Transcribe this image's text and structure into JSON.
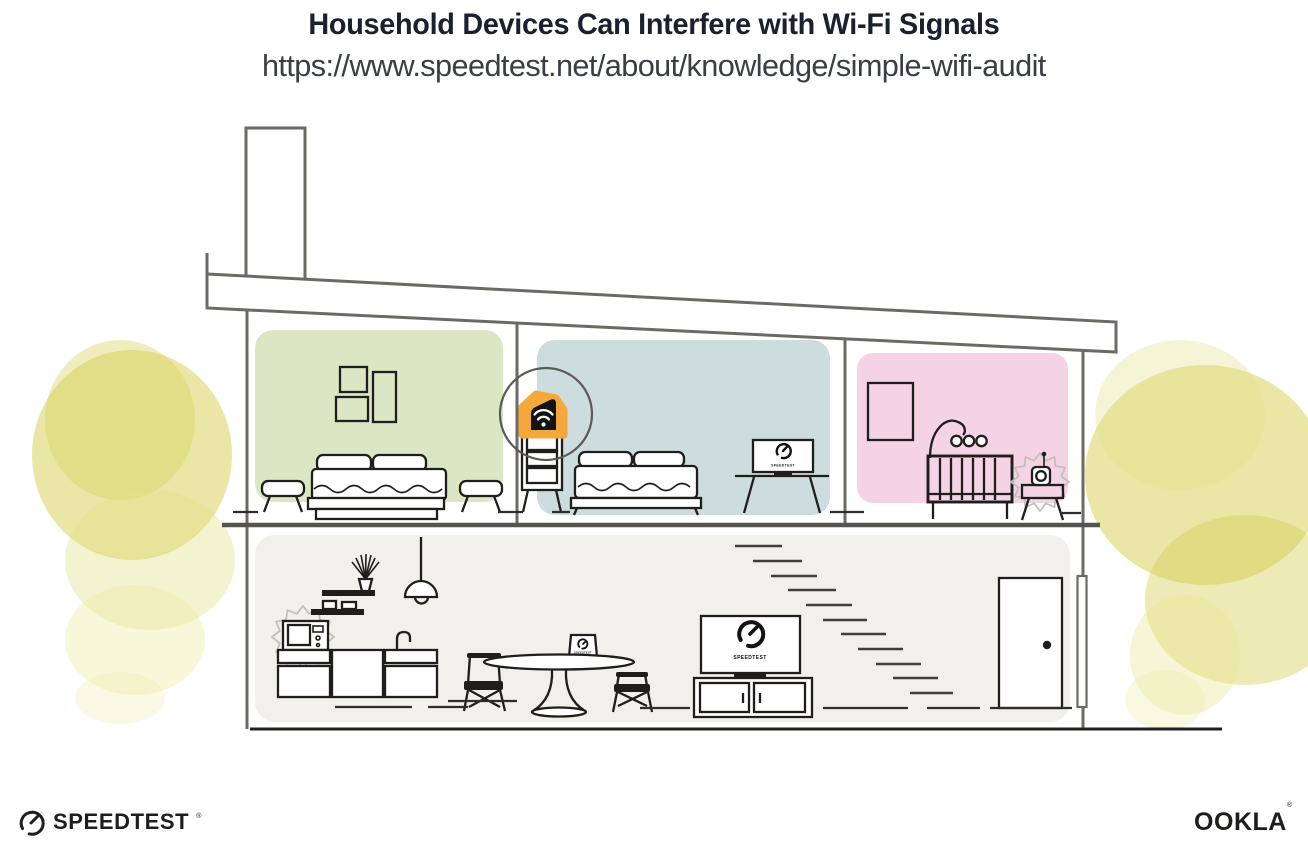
{
  "header": {
    "title": "Household Devices Can Interfere with Wi-Fi Signals",
    "url": "https://www.speedtest.net/about/knowledge/simple-wifi-audit"
  },
  "screens": {
    "tv_label": "SPEEDTEST",
    "bedroom_monitor_label": "SPEEDTEST",
    "dining_laptop_label": "SPEEDTEST"
  },
  "footer": {
    "speedtest_wordmark": "SPEEDTEST",
    "speedtest_trademark": "®",
    "ookla_wordmark": "OOKLA",
    "ookla_trademark": "®"
  },
  "palette": {
    "title_text": "#1A202E",
    "url_text": "#3A3E45",
    "accent_orange": "#F4A83C",
    "bedroom1_green": "#DBE6C4",
    "bedroom2_blue": "#CDDCDD",
    "nursery_pink": "#F3D3E4",
    "main_floor_gray": "#F1F0ED",
    "foliage_yellow": "#D7D15C",
    "structure_gray": "#6B6A64",
    "ink_black": "#1F1E1C"
  },
  "scene": {
    "rooms": [
      "bedroom-1",
      "bedroom-2",
      "nursery",
      "main-floor"
    ],
    "interference_sources": [
      "microwave",
      "baby-monitor"
    ],
    "highlighted_device": "wifi-router"
  }
}
